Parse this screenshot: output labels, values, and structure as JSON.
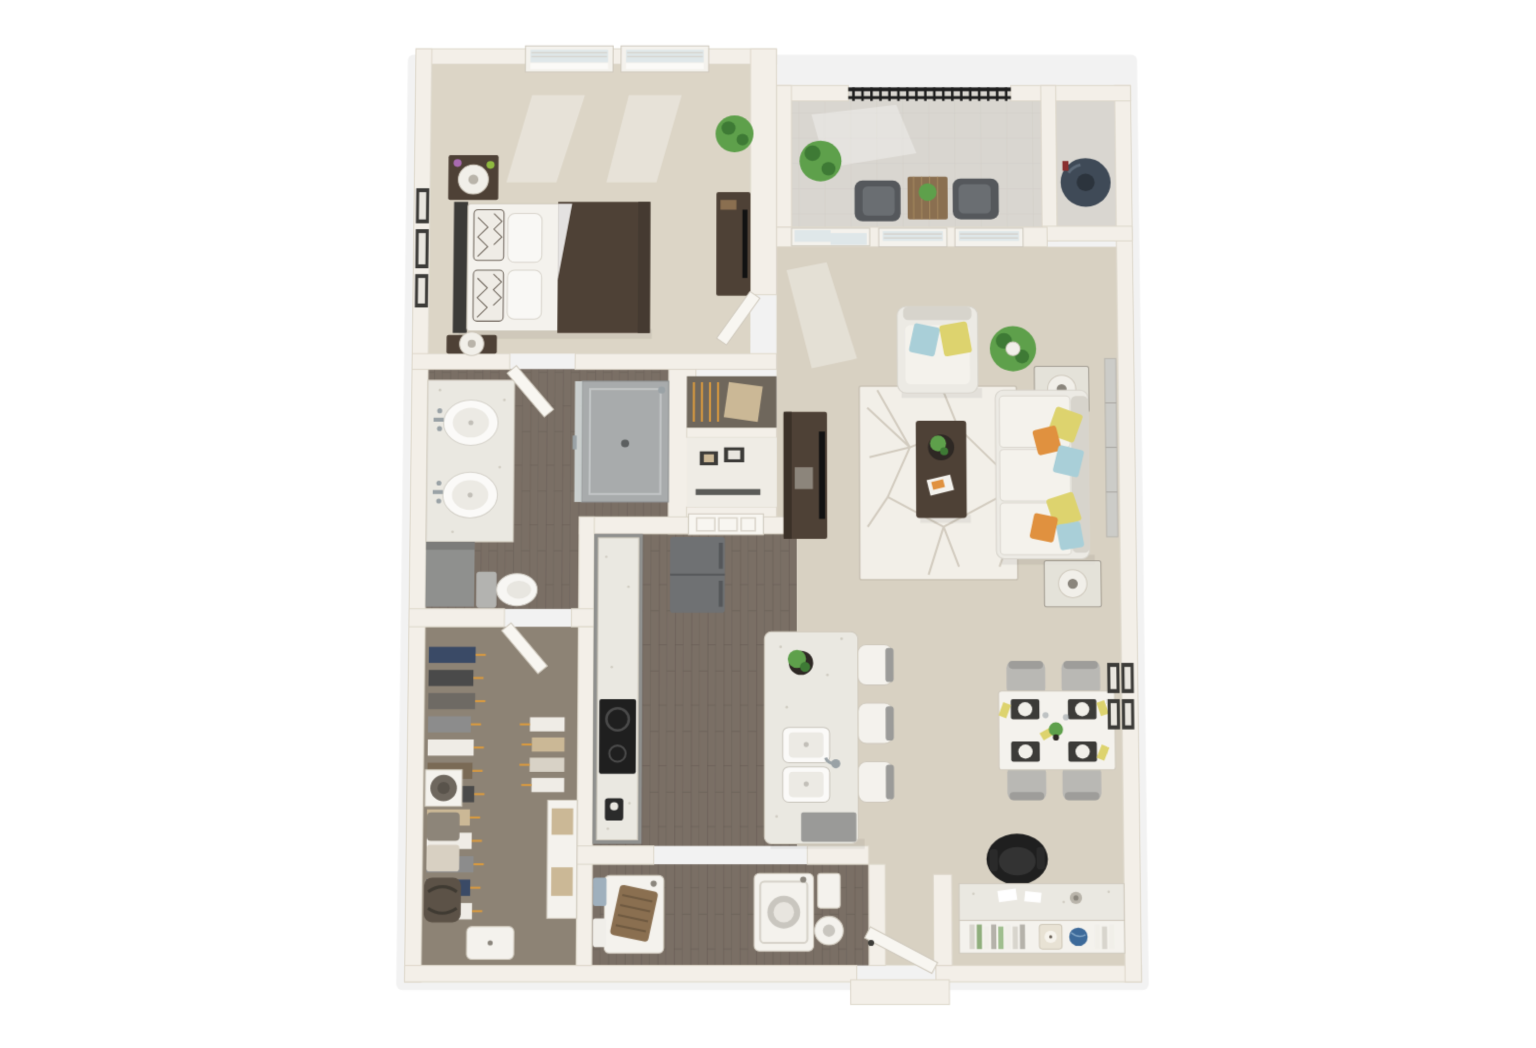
{
  "image": {
    "type": "3d-floor-plan-rendering",
    "view": "top-down dollhouse view",
    "subject": "one-bedroom one-bath apartment floor plan",
    "background": "#ffffff"
  },
  "palette": {
    "wall": "#f3efe8",
    "wall-edge": "#ddd7ca",
    "carpet": "#d8d1c2",
    "carpet-bedroom": "#dcd5c6",
    "carpet-closet": "#8d8375",
    "wood": "#7a6f65",
    "wood-line": "#564d45",
    "tile": "#d9d6d0",
    "rug": "#f2efe8",
    "rug-line": "#c9c2b4",
    "white-furniture": "#f4f2ed",
    "furn-stroke": "#cfc9bd",
    "counter": "#eae8e1",
    "dark-wood": "#4e4136",
    "black": "#1f1f1f",
    "tv-black": "#121212",
    "gray-appliance": "#6f7173",
    "cabinet-gray": "#8f908e",
    "sofa": "#eceae4",
    "sofa-shade": "#d7d4cc",
    "pillow-blue": "#a9cfd8",
    "pillow-yellow": "#ddd36e",
    "pillow-stripe": "#e0913f",
    "green": "#5ea04b",
    "green-dark": "#3e7a35",
    "pot": "#f1efe9",
    "chair-gray": "#b9b8b4",
    "chair-dark": "#55585c",
    "metal": "#9aa2a6",
    "glass": "#dfe7e9",
    "blind": "#d6d5d0",
    "navy": "#3f4a57",
    "basket-brown": "#8a6f50",
    "tan": "#cbb896",
    "towel-blue": "#9fb0bd",
    "frame-dark": "#3c3b38",
    "art-gray": "#ccccc8",
    "hanger-orange": "#d99a3f",
    "door-white": "#f8f6f1",
    "globe-blue": "#3d6a9a"
  },
  "rooms": [
    {
      "id": "bedroom",
      "name": "Bedroom",
      "furniture": [
        "queen-bed",
        "brown-duvet",
        "patterned-pillows",
        "nightstand-with-lamp-left-top",
        "nightstand-with-lamp-left-bottom",
        "wall-frames",
        "potted-plant",
        "media-dresser-with-tv",
        "double-window-left",
        "double-window-right",
        "open-door"
      ]
    },
    {
      "id": "bathroom",
      "name": "Bathroom",
      "furniture": [
        "double-sink-vanity",
        "lower-cabinet",
        "toilet",
        "walk-in-shower",
        "open-door"
      ]
    },
    {
      "id": "walk-in-closet",
      "name": "Walk-in Closet",
      "furniture": [
        "hanging-clothes-left",
        "hanging-clothes-right",
        "shelf-with-hat",
        "shelf-with-bags",
        "duffel-bag",
        "shelf-tower-with-boxes",
        "storage-ottoman",
        "open-door"
      ]
    },
    {
      "id": "balcony",
      "name": "Balcony",
      "furniture": [
        "metal-railing",
        "outdoor-chair-left",
        "outdoor-chair-right",
        "wood-side-table",
        "table-plant",
        "floor-plant"
      ]
    },
    {
      "id": "storage",
      "name": "Storage / Utility Closet",
      "furniture": [
        "water-heater"
      ]
    },
    {
      "id": "living-room",
      "name": "Living Room",
      "furniture": [
        "sliding-glass-door",
        "window-left",
        "window-right",
        "armchair-with-pillows",
        "floor-plant",
        "end-table-lamp-top",
        "sofa-with-pillows",
        "end-table-lamp-bottom",
        "geometric-area-rug",
        "coffee-table-with-decor",
        "tv-console-with-tv",
        "wall-art-panels"
      ]
    },
    {
      "id": "kitchen",
      "name": "Kitchen",
      "furniture": [
        "refrigerator",
        "cabinet-run-with-counter",
        "cooktop",
        "kitchen-island",
        "island-plant",
        "double-basin-sink-with-faucet",
        "dishwasher",
        "bar-stool-1",
        "bar-stool-2",
        "bar-stool-3",
        "hallway-door"
      ]
    },
    {
      "id": "dining-area",
      "name": "Dining Area",
      "furniture": [
        "dining-table",
        "place-settings",
        "yellow-napkins",
        "dining-chair-top-left",
        "dining-chair-top-right",
        "dining-chair-bottom-left",
        "dining-chair-bottom-right",
        "gallery-wall-frames"
      ]
    },
    {
      "id": "laundry",
      "name": "Laundry Closet",
      "furniture": [
        "washer-with-basket",
        "dryer",
        "towel-stack-blue",
        "towel-stack-white",
        "storage-box",
        "round-hamper"
      ]
    },
    {
      "id": "entry",
      "name": "Entry",
      "furniture": [
        "front-door-open",
        "exterior-stoop",
        "partition-wall"
      ]
    },
    {
      "id": "desk-nook",
      "name": "Desk Nook",
      "furniture": [
        "built-in-desk",
        "office-chair",
        "bookshelf",
        "books",
        "clock",
        "globe"
      ]
    }
  ]
}
